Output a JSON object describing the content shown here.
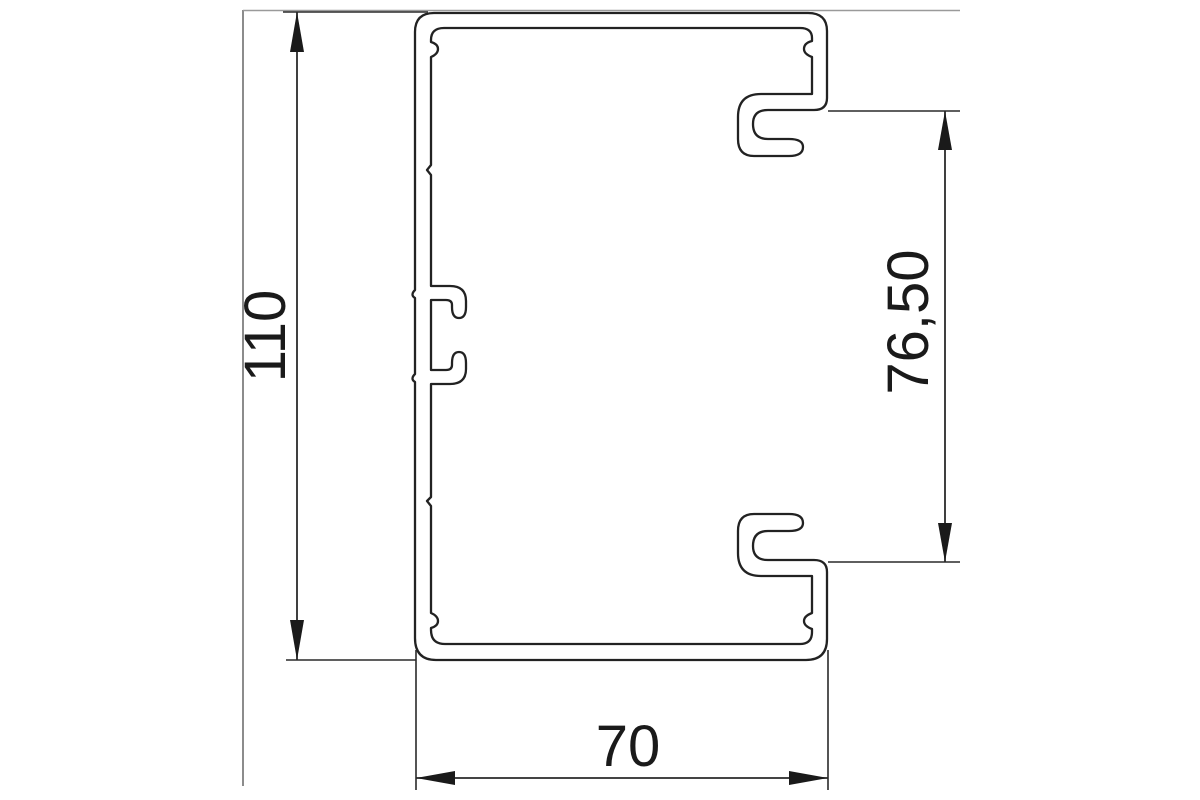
{
  "drawing": {
    "type": "technical cross-section drawing",
    "subject": "cable trunking profile",
    "background_color": "#ffffff",
    "outline_color": "#222222",
    "dimension_line_color": "#2a2a2a",
    "frame_line_color": "#8c8c8c",
    "dimensions": [
      {
        "id": "overall-height",
        "label": "110",
        "orientation": "vertical",
        "position": "left"
      },
      {
        "id": "cover-opening-height",
        "label": "76,50",
        "orientation": "vertical",
        "position": "right"
      },
      {
        "id": "overall-width",
        "label": "70",
        "orientation": "horizontal",
        "position": "bottom"
      }
    ]
  }
}
